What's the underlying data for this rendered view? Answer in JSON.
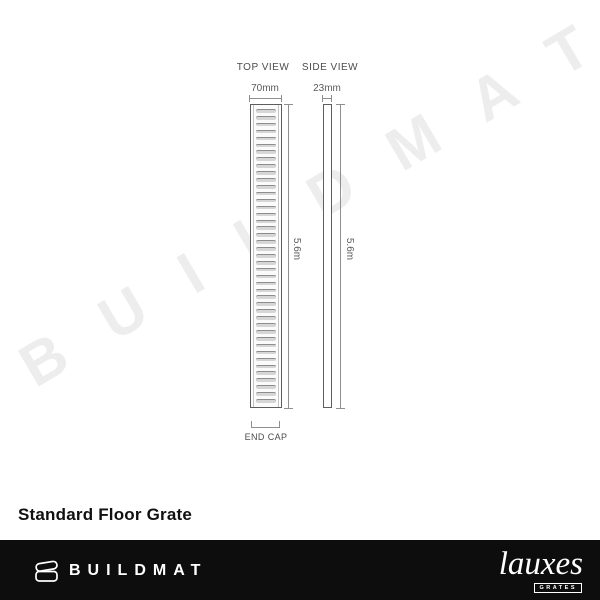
{
  "watermark": {
    "text": "B U I L D M A T",
    "color": "#ededed"
  },
  "diagram": {
    "top_view": {
      "label": "TOP VIEW",
      "width_dim": "70mm",
      "length_dim": "5.6m",
      "end_cap_label": "END CAP",
      "slat_count": 43
    },
    "side_view": {
      "label": "SIDE VIEW",
      "width_dim": "23mm",
      "length_dim": "5.6m"
    }
  },
  "title": "Standard Floor Grate",
  "footer": {
    "brand": "BUILDMAT",
    "partner": {
      "name": "lauxes",
      "sub": "GRATES"
    },
    "background": "#0d0d0d"
  }
}
